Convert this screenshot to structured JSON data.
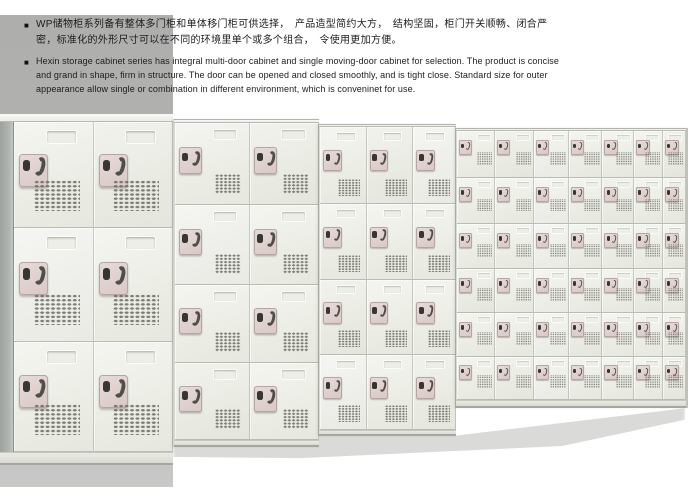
{
  "intro": {
    "zh": {
      "bullet": "■",
      "lines": [
        "WP储物柜系列备有整体多门柜和单体移门柜可供选择，　产品造型简约大方，　结构坚固，柜门开关顺畅、闭合严",
        "密，标准化的外形尺寸可以在不同的环境里单个或多个组合，　令使用更加方便。"
      ]
    },
    "en": {
      "bullet": "■",
      "lines": [
        "Hexin storage cabinet series has integral multi-door cabinet and single moving-door cabinet for selection. The product is concise",
        "and grand in shape, firm in structure. The door can be opened and closed smoothly, and is tight close. Standard size for outer",
        "appearance allow single or combination in different environment, which is conveninet for use."
      ]
    }
  },
  "colors": {
    "page_bg": "#ffffff",
    "text": "#1c1c1c",
    "gray_panel": "#b3b3b2",
    "cabinet_face": "#eff0ea",
    "cabinet_seam": "#c9cac2",
    "cabinet_side": "#a7aca9",
    "lock_plate": "#d9c9c7",
    "lock_metal": "#4f4e47",
    "vent_dot": "#6b6b63",
    "shadow": "#a8a8a2"
  },
  "scene": {
    "description": "row of WP storage lockers photographed in perspective, receding to the right",
    "sections": [
      {
        "id": "cab-a",
        "label": "3-tier 2-column locker",
        "left": 0,
        "top": 113,
        "width": 173,
        "height": 352,
        "side": 13,
        "lid": 9,
        "base": 13,
        "cols": [
          80,
          79
        ],
        "rows": [
          106,
          114,
          110
        ],
        "scale": 1.0
      },
      {
        "id": "cab-b",
        "label": "4-tier 2-column locker",
        "left": 173,
        "top": 119,
        "width": 145,
        "height": 328,
        "side": 0,
        "lid": 4,
        "base": 7,
        "cols": [
          76,
          69
        ],
        "rows": [
          82,
          80,
          78,
          77
        ],
        "scale": 0.78
      },
      {
        "id": "cab-c",
        "label": "4-tier 3-column locker",
        "left": 318,
        "top": 124,
        "width": 137,
        "height": 312,
        "side": 0,
        "lid": 3,
        "base": 6,
        "cols": [
          47,
          47,
          43
        ],
        "rows": [
          77,
          76,
          75,
          75
        ],
        "scale": 0.62
      },
      {
        "id": "cab-d",
        "label": "6-tier 7-column locker",
        "left": 455,
        "top": 128,
        "width": 230,
        "height": 280,
        "side": 0,
        "lid": 3,
        "base": 8,
        "cols": [
          38,
          39,
          35,
          34,
          32,
          29,
          23
        ],
        "rows": [
          47,
          46,
          45,
          44,
          44,
          43
        ],
        "scale": 0.42
      }
    ]
  }
}
